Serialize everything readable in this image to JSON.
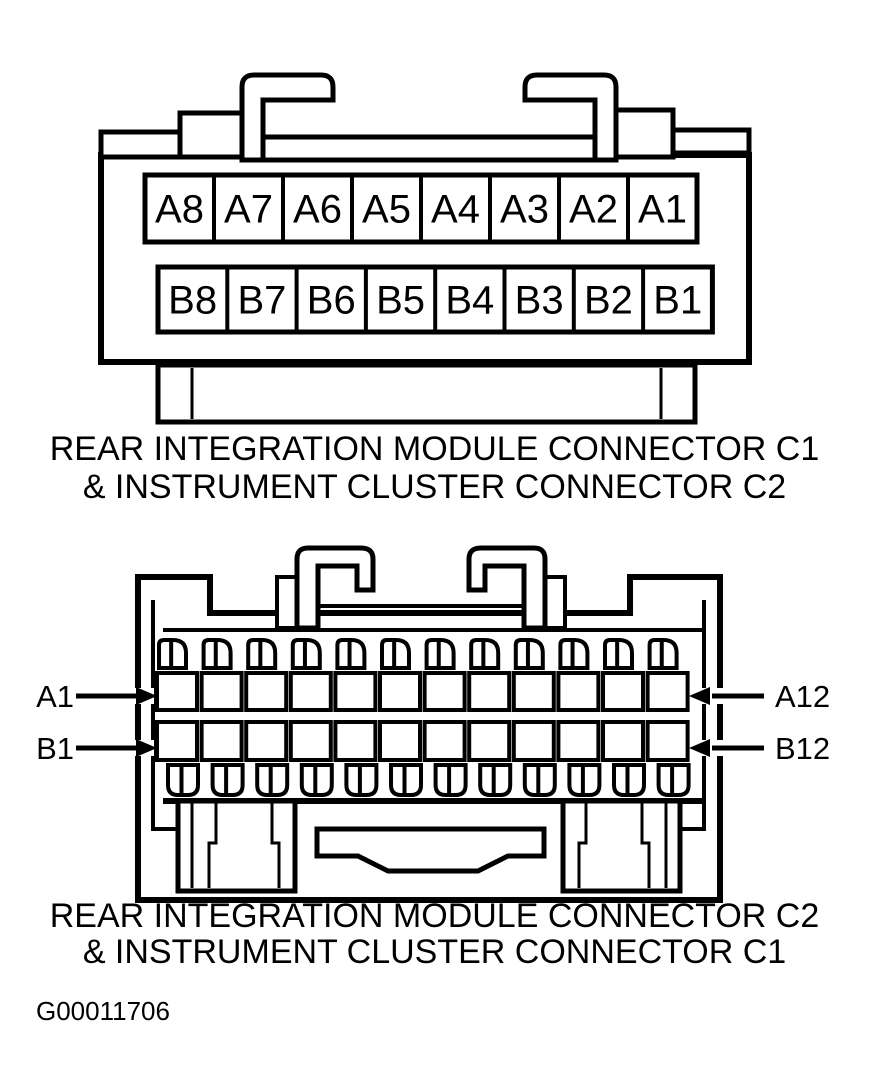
{
  "colors": {
    "ink": "#000000",
    "paper": "#ffffff"
  },
  "figure_id": "G00011706",
  "connector1": {
    "caption_line1": "REAR INTEGRATION MODULE CONNECTOR C1",
    "caption_line2": "& INSTRUMENT CLUSTER CONNECTOR C2",
    "row_a_pins": [
      "A8",
      "A7",
      "A6",
      "A5",
      "A4",
      "A3",
      "A2",
      "A1"
    ],
    "row_b_pins": [
      "B8",
      "B7",
      "B6",
      "B5",
      "B4",
      "B3",
      "B2",
      "B1"
    ]
  },
  "connector2": {
    "caption_line1": "REAR INTEGRATION MODULE CONNECTOR C2",
    "caption_line2": "& INSTRUMENT CLUSTER CONNECTOR C1",
    "row_a_pin_count": 12,
    "row_b_pin_count": 12,
    "terminal_count_top": 12,
    "terminal_count_bottom": 12,
    "pin_labels": {
      "row_a_first": "A1",
      "row_a_last": "A12",
      "row_b_first": "B1",
      "row_b_last": "B12"
    }
  }
}
